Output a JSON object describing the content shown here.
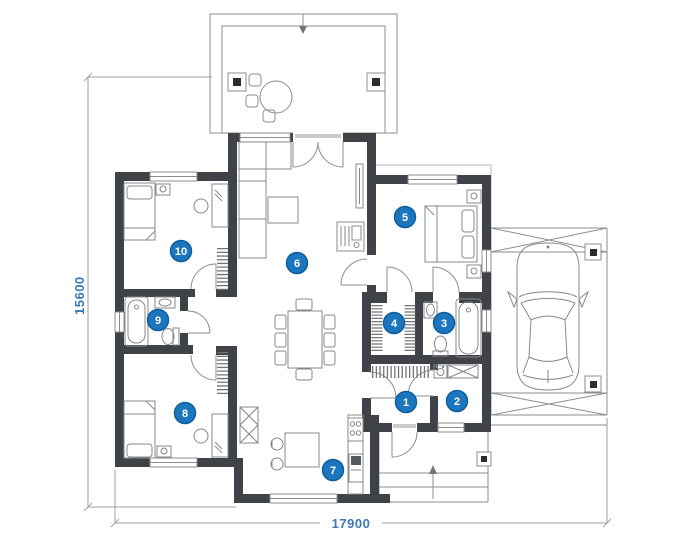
{
  "plan": {
    "dims": {
      "height": "15600",
      "width": "17900"
    },
    "markers": [
      "1",
      "2",
      "3",
      "4",
      "5",
      "6",
      "7",
      "8",
      "9",
      "10"
    ],
    "colors": {
      "wall": "#3f4347",
      "marker_fill": "#1c76bd",
      "marker_rim": "#0f5d9d",
      "dimension_text": "#3c78b4",
      "thin_line": "#9aa0a3",
      "furniture_line": "#84888b"
    }
  }
}
